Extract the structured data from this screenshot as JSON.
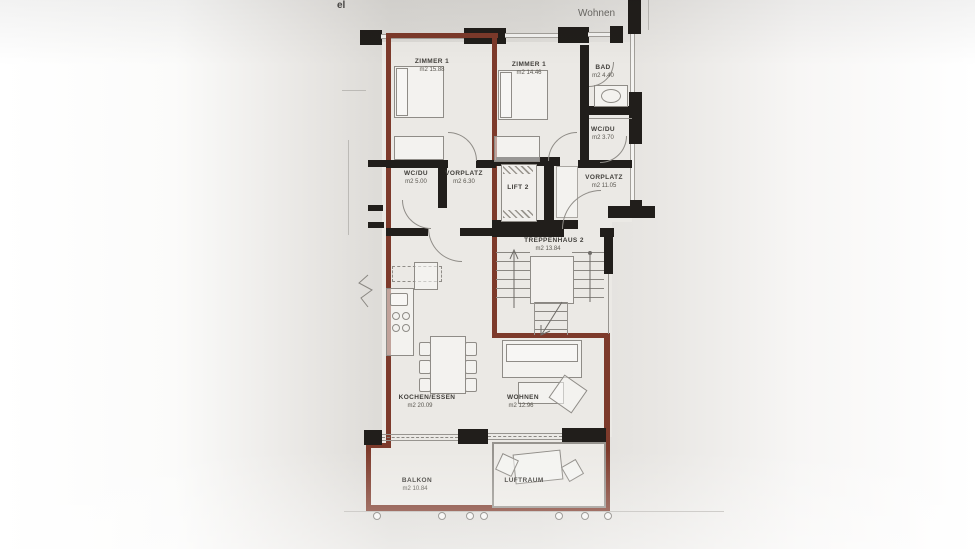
{
  "annotations": {
    "top_left_fragment": "el",
    "top_right_label": "Wohnen"
  },
  "rooms": [
    {
      "id": "zimmer1-left",
      "label": "ZIMMER 1",
      "area": "m2 15.88"
    },
    {
      "id": "zimmer1-right",
      "label": "ZIMMER 1",
      "area": "m2 14.46"
    },
    {
      "id": "bad",
      "label": "BAD",
      "area": "m2 4.40"
    },
    {
      "id": "wcdu-right",
      "label": "WC/DU",
      "area": "m2 3.70"
    },
    {
      "id": "wcdu-left",
      "label": "WC/DU",
      "area": "m2 5.00"
    },
    {
      "id": "vorplatz-left",
      "label": "VORPLATZ",
      "area": "m2 6.30"
    },
    {
      "id": "lift-2",
      "label": "LIFT 2",
      "area": ""
    },
    {
      "id": "vorplatz-right",
      "label": "VORPLATZ",
      "area": "m2 11.05"
    },
    {
      "id": "treppenhaus-2",
      "label": "TREPPENHAUS 2",
      "area": "m2 13.84"
    },
    {
      "id": "kochen-essen",
      "label": "KOCHEN/ESSEN",
      "area": "m2 20.09"
    },
    {
      "id": "wohnen",
      "label": "WOHNEN",
      "area": "m2 12.96"
    },
    {
      "id": "balkon",
      "label": "BALKON",
      "area": "m2 10.84"
    },
    {
      "id": "luftraum",
      "label": "LUFTRAUM",
      "area": ""
    }
  ],
  "icons": {
    "furniture": [
      "bed-icon",
      "wardrobe-icon",
      "washbasin-icon",
      "kitchen-counter-icon",
      "sink-icon",
      "stove-burner-icon",
      "dining-table-icon",
      "chair-icon",
      "sofa-icon",
      "coffee-table-icon",
      "armchair-icon",
      "outdoor-table-icon",
      "stair-arrow-icon",
      "railing-post-icon",
      "break-line-icon"
    ]
  },
  "colors": {
    "apartment_outline": "#7d3a2b",
    "walls": "#211e1b",
    "paper": "#dfddd9",
    "drawing_lines": "#8f8c87"
  }
}
